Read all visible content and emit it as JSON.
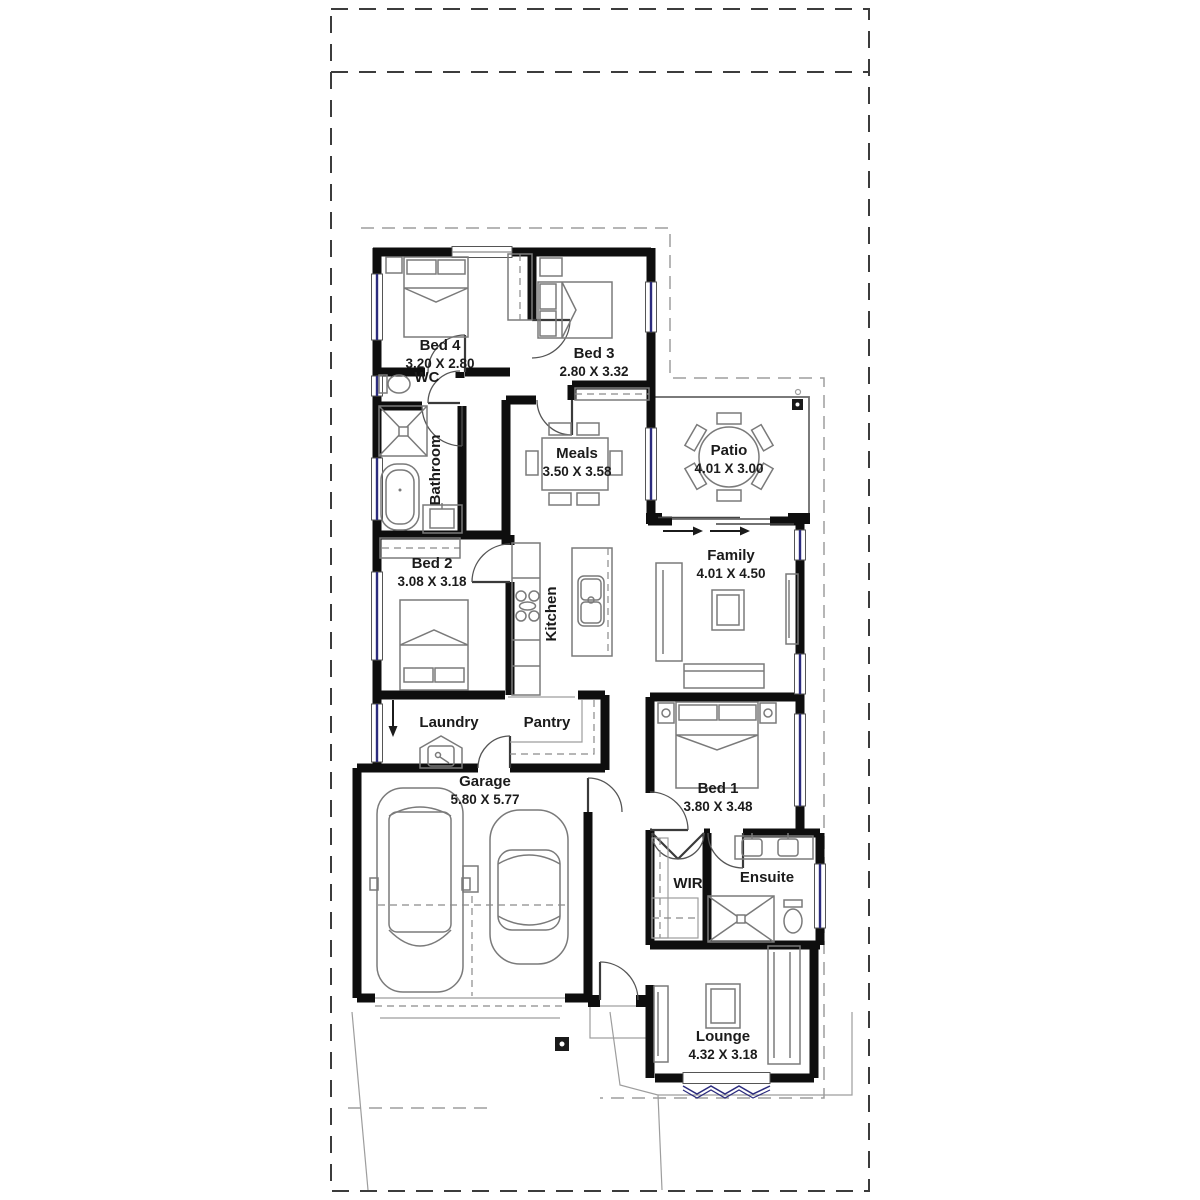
{
  "plan": {
    "rooms": [
      {
        "name": "Bed 4",
        "dims": "3.20 X 2.80"
      },
      {
        "name": "Bed 3",
        "dims": "2.80 X 3.32"
      },
      {
        "name": "WC",
        "dims": ""
      },
      {
        "name": "Bathroom",
        "dims": ""
      },
      {
        "name": "Meals",
        "dims": "3.50 X 3.58"
      },
      {
        "name": "Patio",
        "dims": "4.01 X 3.00"
      },
      {
        "name": "Family",
        "dims": "4.01 X 4.50"
      },
      {
        "name": "Kitchen",
        "dims": ""
      },
      {
        "name": "Bed 2",
        "dims": "3.08 X 3.18"
      },
      {
        "name": "Laundry",
        "dims": ""
      },
      {
        "name": "Pantry",
        "dims": ""
      },
      {
        "name": "Garage",
        "dims": "5.80 X 5.77"
      },
      {
        "name": "Bed 1",
        "dims": "3.80 X 3.48"
      },
      {
        "name": "WIR",
        "dims": ""
      },
      {
        "name": "Ensuite",
        "dims": ""
      },
      {
        "name": "Lounge",
        "dims": "4.32 X 3.18"
      }
    ],
    "colors": {
      "wall": "#0e0e0e",
      "window": "#2b2b7d",
      "boundary": "#3c3c3c",
      "envelope": "#9d9d9d",
      "furniture": "#7a7a7a",
      "label": "#1b1b1b",
      "paper": "#ffffff"
    }
  }
}
